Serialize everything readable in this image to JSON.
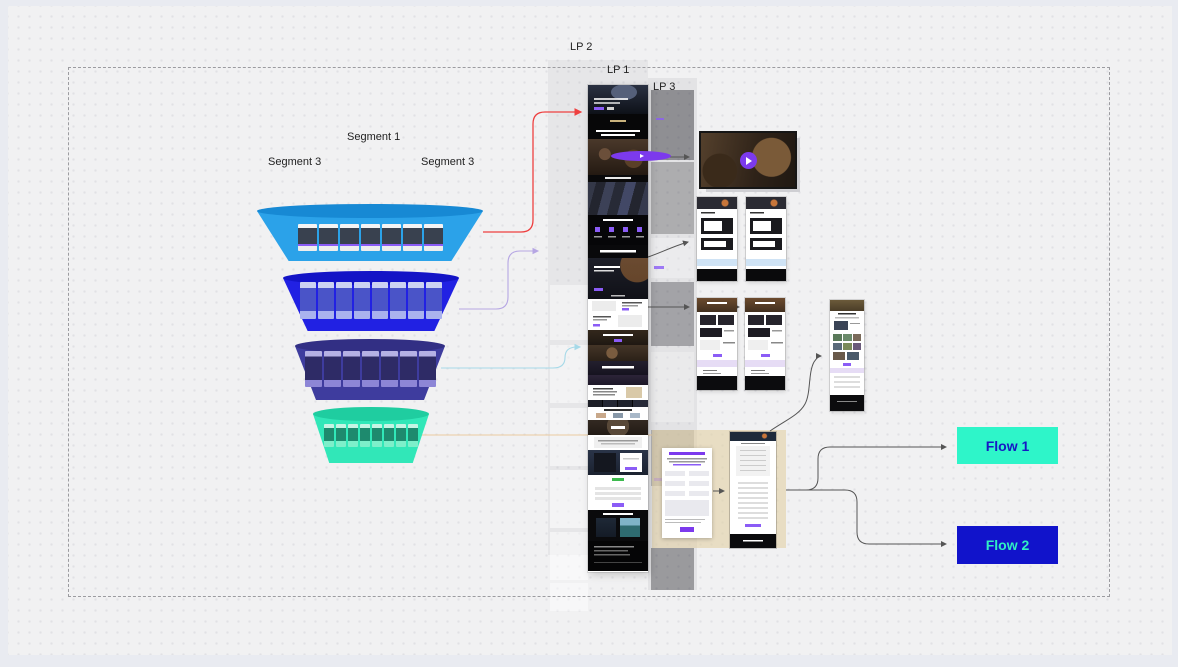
{
  "app": {
    "type": "design-canvas-whiteboard"
  },
  "canvas": {
    "frame_color": "#e9ebf1",
    "background": "#f1f1f2",
    "dot_color": "#e1e1e5",
    "selection_dash_color": "#9c9ca0"
  },
  "labels": {
    "segment_1": "Segment 1",
    "segment_3_left": "Segment 3",
    "segment_3_right": "Segment 3",
    "lp_1": "LP 1",
    "lp_2": "LP 2",
    "lp_3": "LP 3"
  },
  "funnel": {
    "layers": [
      {
        "id": "segment-1-ads",
        "color": "#2BA2E9",
        "rim_color": "#1789D4",
        "thumbs": 7
      },
      {
        "id": "segment-2-ads",
        "color": "#2121E3",
        "rim_color": "#1414C6",
        "thumbs": 8
      },
      {
        "id": "segment-3-ads",
        "color": "#3E3C9E",
        "rim_color": "#322F84",
        "thumbs": 7
      },
      {
        "id": "segment-4-ads",
        "color": "#31E7B8",
        "rim_color": "#1FCDA0",
        "thumbs": 8
      }
    ]
  },
  "flows": {
    "flow_1": {
      "label": "Flow 1",
      "bg": "#2EF5C9",
      "text_color": "#1717C4"
    },
    "flow_2": {
      "label": "Flow 2",
      "bg": "#1113CB",
      "text_color": "#30EFC3"
    }
  },
  "connectors": {
    "red": "#EE4040",
    "purple": "#B6A6E3",
    "cyan": "#A6D9E8",
    "orange": "#EBCBA0",
    "dark": "#555555"
  },
  "accents": {
    "play_button": "#7C3AED",
    "cta_purple": "#8B5CF6"
  }
}
